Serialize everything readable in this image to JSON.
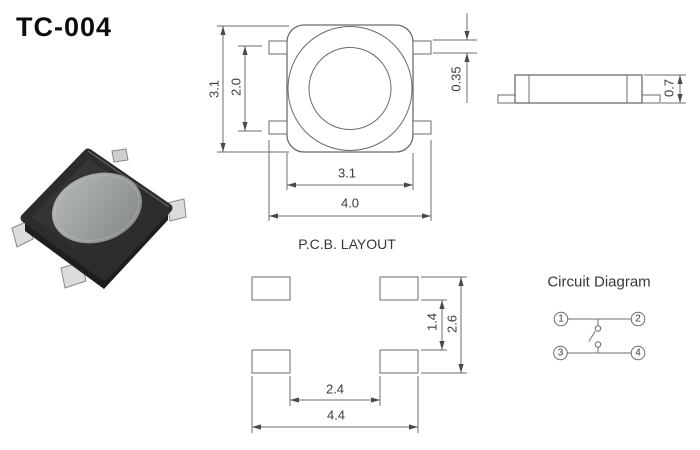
{
  "title": "TC-004",
  "palette": {
    "line": "#6e6e6e",
    "dimension_text": "#3c3c3c",
    "title_text": "#0d0d0d",
    "photo_body": "#333333",
    "photo_button": "#9b9d9a"
  },
  "top_view": {
    "dim_outer_height": "3.1",
    "dim_lead_span": "2.0",
    "dim_body_width": "3.1",
    "dim_overall_width": "4.0",
    "dim_lead_thickness": "0.35"
  },
  "side_view": {
    "dim_height": "0.7"
  },
  "pcb_layout": {
    "title": "P.C.B. LAYOUT",
    "dim_pad_inner_gap_v": "1.4",
    "dim_pad_outer_span_v": "2.6",
    "dim_pad_inner_gap_h": "2.4",
    "dim_pad_outer_span_h": "4.4"
  },
  "circuit_diagram": {
    "title": "Circuit Diagram",
    "pins": [
      "1",
      "2",
      "3",
      "4"
    ]
  }
}
